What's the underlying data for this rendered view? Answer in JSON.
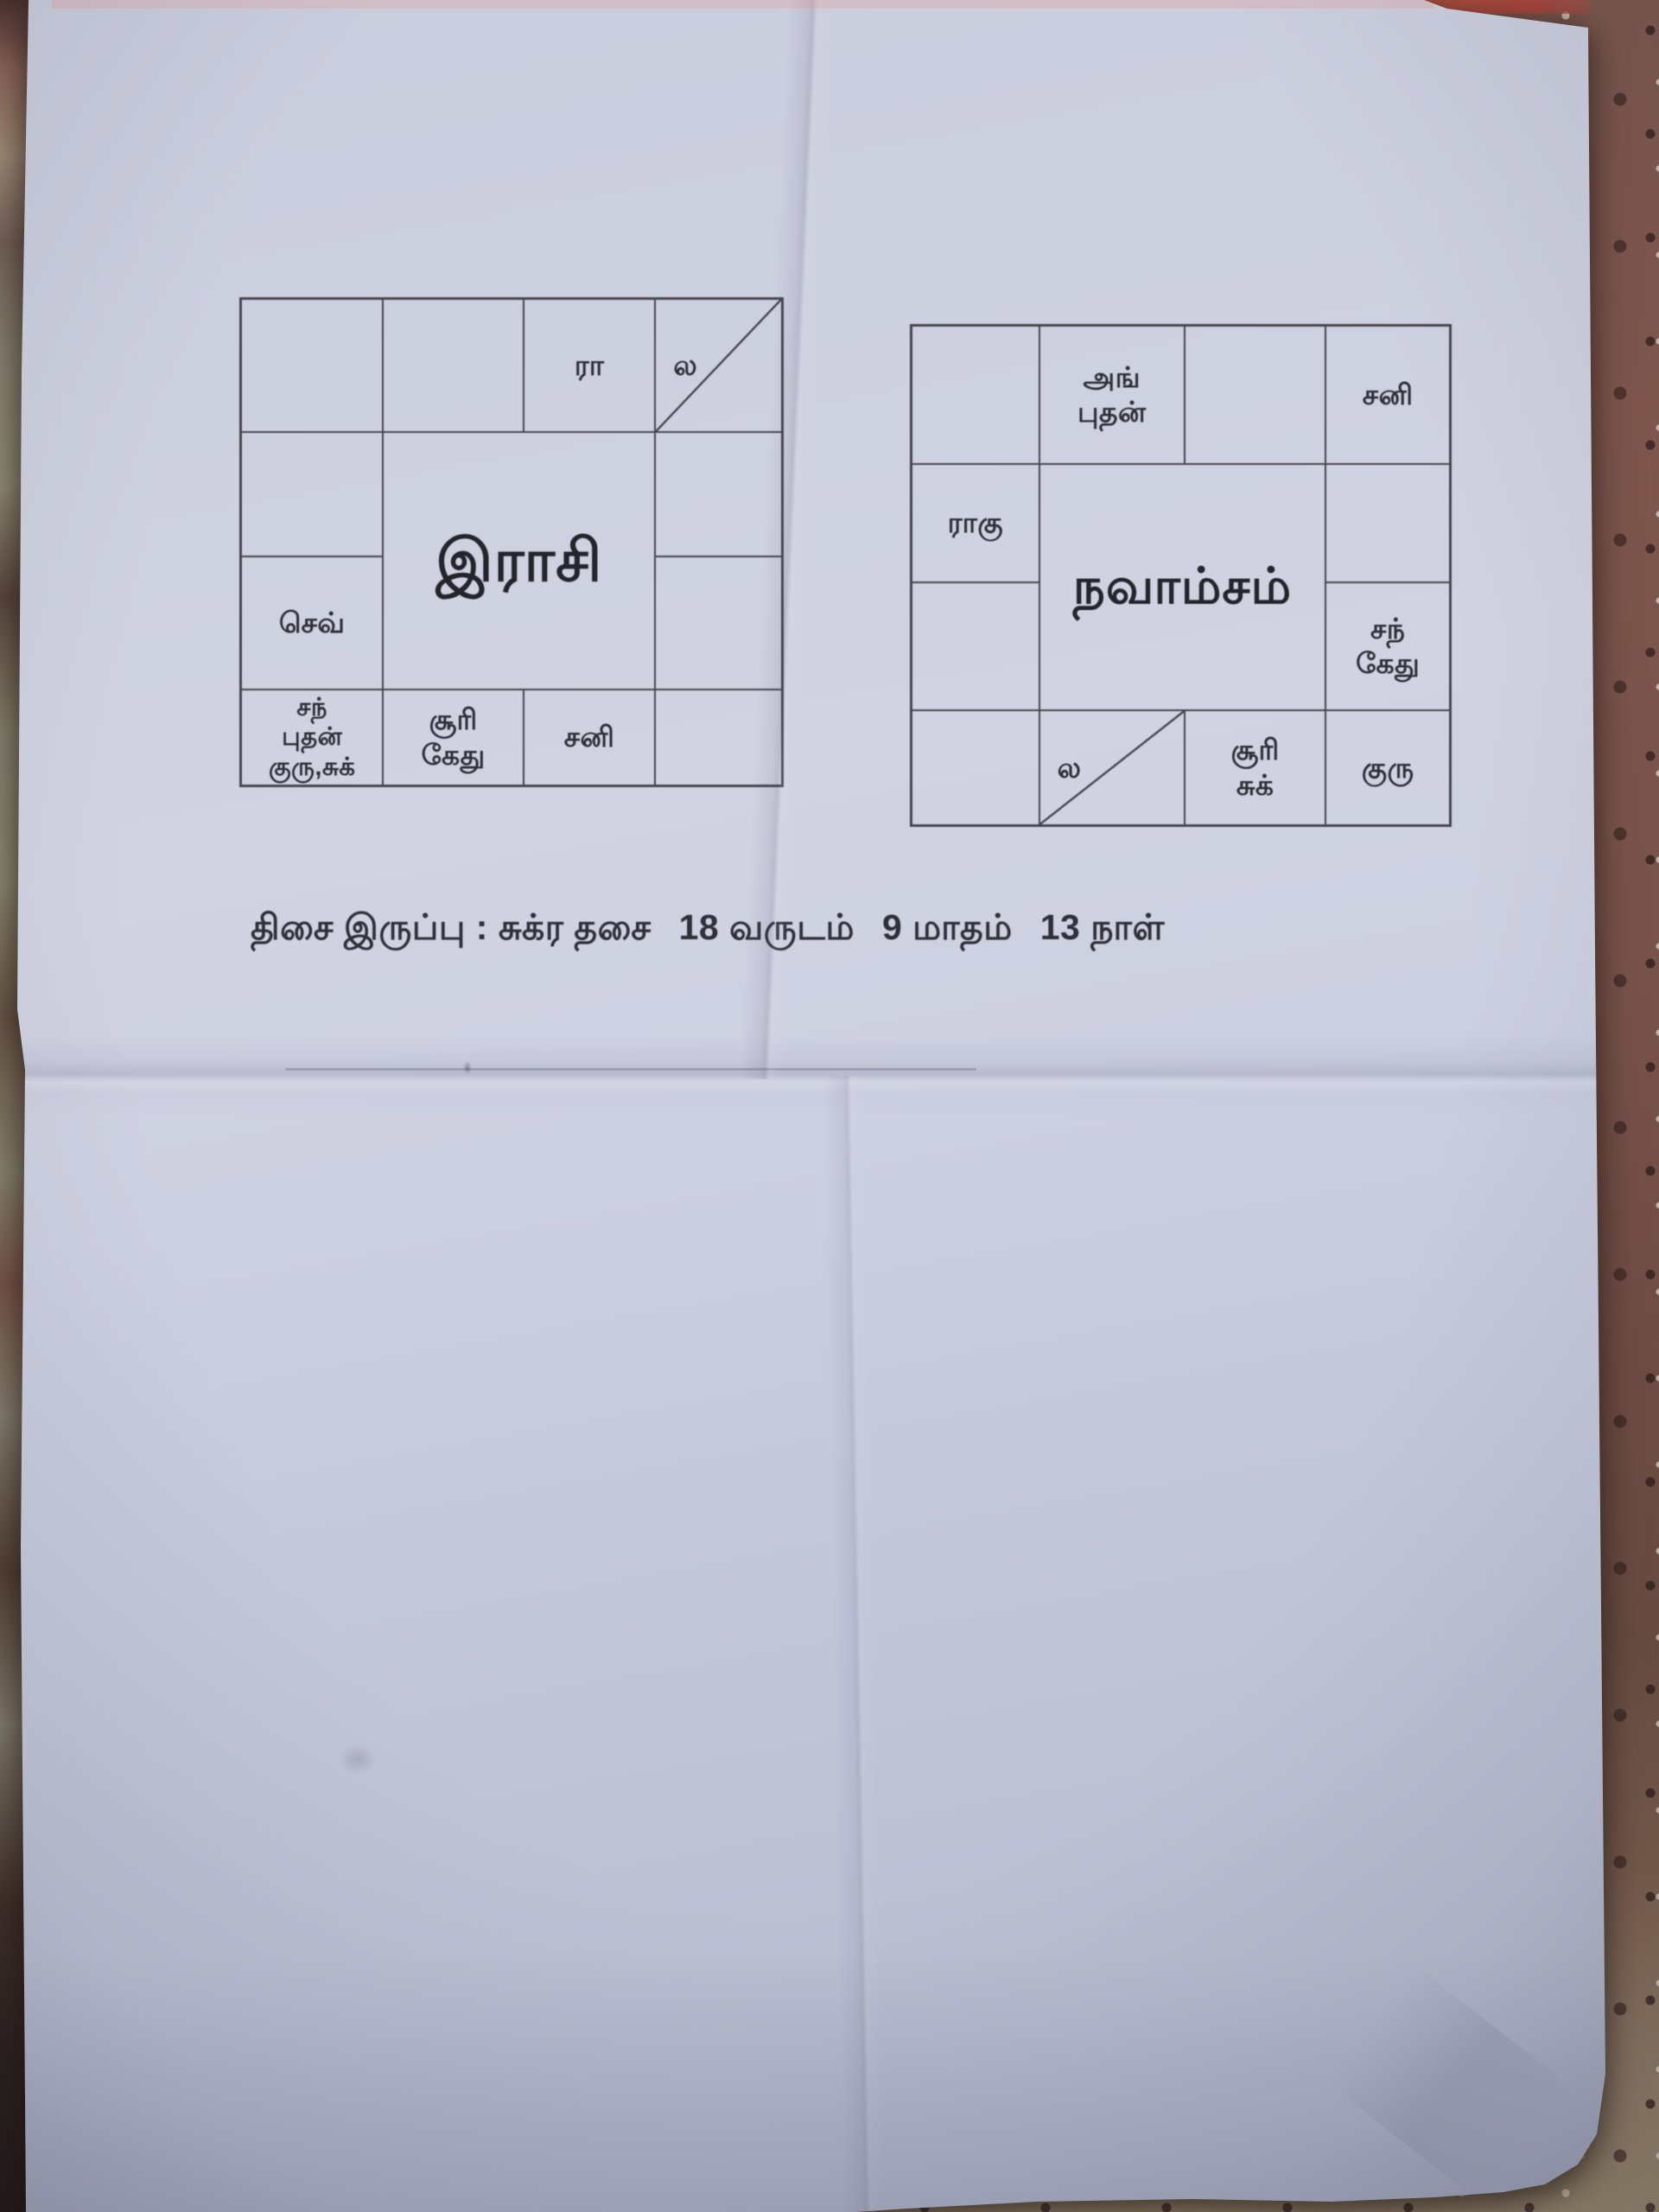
{
  "charts": [
    {
      "title": "இராசி",
      "cells": {
        "r1c3": "ரா",
        "r1c4": "ல",
        "r3c1": "செவ்",
        "r4c1": "சந்\nபுதன்\nகுரு,சுக்",
        "r4c2": "சூரி\nகேது",
        "r4c3": "சனி"
      }
    },
    {
      "title": "நவாம்சம்",
      "cells": {
        "r1c2": "அங்\nபுதன்",
        "r1c4": "சனி",
        "r2c1": "ராகு",
        "r3c4": "சந்\nகேது",
        "r4c2": "ல",
        "r4c3": "சூரி\nசுக்",
        "r4c4": "குரு"
      }
    }
  ],
  "caption": {
    "parts": [
      "திசை இருப்பு : சுக்ர தசை",
      "18 வருடம்",
      "9 மாதம்",
      "13 நாள்"
    ]
  },
  "colors": {
    "paper": "#cdd0e0",
    "ink_lines": "#46464f",
    "ink_text": "#2e2e38",
    "floor_red_granite": "#7d564d",
    "floor_chip_light": "#dcd2c0",
    "floor_chip_dark": "#3c2724",
    "floor_left_olive": "#8f8a74",
    "floor_bottom_tan": "#9c8c72"
  }
}
